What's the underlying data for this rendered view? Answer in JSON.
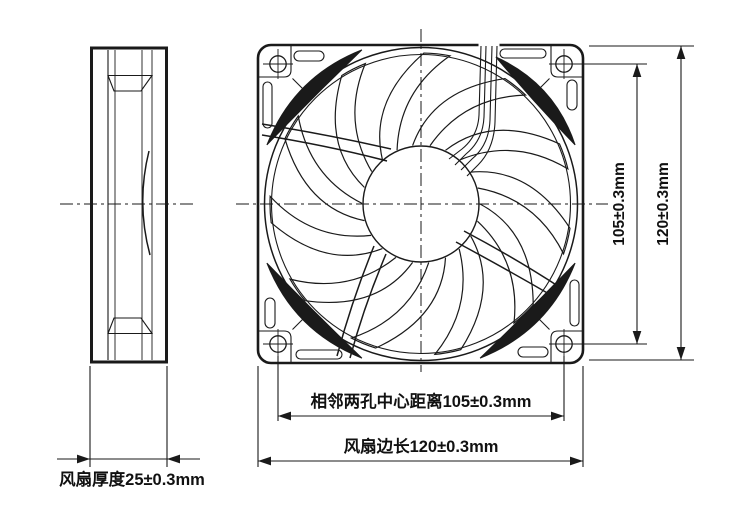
{
  "drawing": {
    "kind": "fan engineering drawing, side view and front view",
    "colors": {
      "line": "#1a1a1a",
      "background": "#ffffff"
    }
  },
  "labels": {
    "thickness": "风扇厚度25±0.3mm",
    "hole_pitch_horizontal": "相邻两孔中心距离105±0.3mm",
    "side_length_horizontal": "风扇边长120±0.3mm",
    "hole_pitch_vertical": "105±0.3mm",
    "side_length_vertical": "120±0.3mm"
  }
}
